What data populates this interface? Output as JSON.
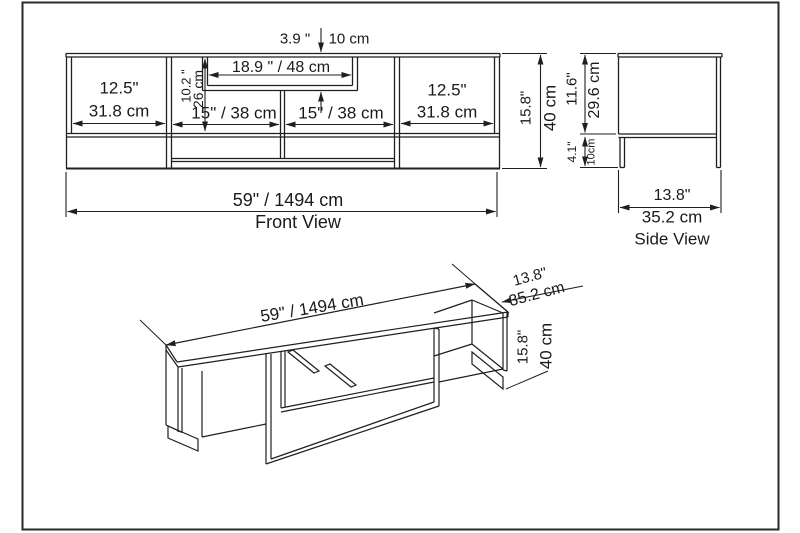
{
  "document": {
    "kind": "furniture technical drawing",
    "line_color": "#1f1f1f",
    "background_color": "#ffffff"
  },
  "front_view": {
    "title": "Front View",
    "overall_width": "59\" / 1494 cm",
    "overall_height_in": "15.8\"",
    "overall_height_cm": "40 cm",
    "top_gap_in": "3.9 \"",
    "top_gap_cm": "10 cm",
    "recess_width": "18.9 \" / 48 cm",
    "recess_height_in": "10.2 \"",
    "recess_height_cm": "26 cm",
    "left_compartment_in": "12.5\"",
    "left_compartment_cm": "31.8 cm",
    "mid_left_compartment": "15\" / 38 cm",
    "mid_right_compartment": "15\" / 38 cm",
    "right_compartment_in": "12.5\"",
    "right_compartment_cm": "31.8 cm"
  },
  "side_view": {
    "title": "Side View",
    "depth_in": "13.8\"",
    "depth_cm": "35.2 cm",
    "upper_height_in": "11.6\"",
    "upper_height_cm": "29.6 cm",
    "lower_height_in": "4.1\"",
    "lower_height_cm": "10cm"
  },
  "perspective_view": {
    "width": "59\" / 1494 cm",
    "depth_in": "13.8\"",
    "depth_cm": "35.2 cm",
    "height_in": "15.8\"",
    "height_cm": "40 cm"
  }
}
